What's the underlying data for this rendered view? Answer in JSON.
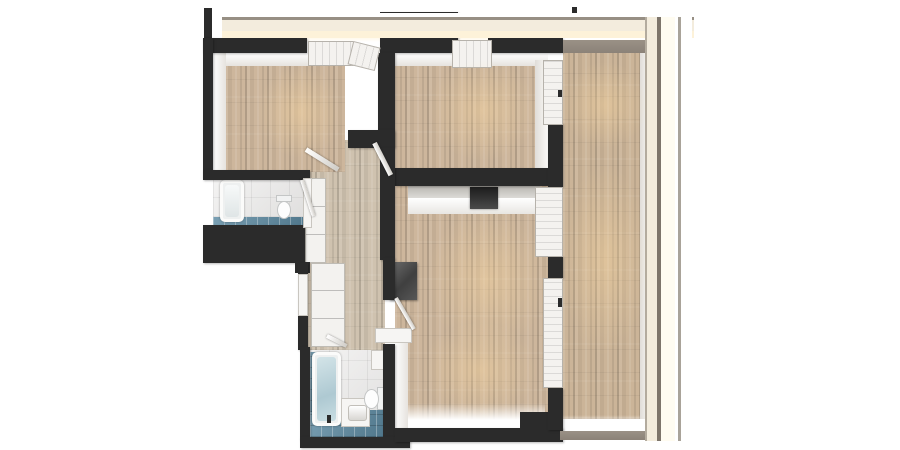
{
  "scene": {
    "title": "Apartment floor plan — top-down 3D render",
    "type": "architectural-floorplan-render",
    "view": "top-down",
    "background": "#ffffff",
    "text_visible": "none"
  },
  "palette": {
    "wall": "#2b2b2b",
    "wood": "#cdb69c",
    "hallWood": "#cfc2af",
    "balconyWood": "#cbb498",
    "whiteFace": "#f1efec",
    "tileFloor": "#e9e8e7",
    "blueTile": "#5d8ba3",
    "railCream": "#f3ecdd",
    "railBrown": "#8b8278",
    "counterTop": "#c9c7c3",
    "appliance": "#3b3b3b",
    "glow": "#ffdfae"
  },
  "rooms": [
    {
      "id": "bedroom-1",
      "label": "Bedroom 1 (top left)"
    },
    {
      "id": "bedroom-2",
      "label": "Bedroom 2 (top middle)"
    },
    {
      "id": "bathroom-1",
      "label": "Bathroom 1 (bathtub + toilet)"
    },
    {
      "id": "bathroom-2",
      "label": "Bathroom 2 (bathtub, vanity, toilet)"
    },
    {
      "id": "hallway",
      "label": "Hallway"
    },
    {
      "id": "living-kitchen",
      "label": "Living room / Kitchen"
    },
    {
      "id": "balcony",
      "label": "Balcony / Loggia"
    }
  ],
  "fixtures": [
    {
      "id": "bathtub-1",
      "label": "Bathtub"
    },
    {
      "id": "toilet-1",
      "label": "Toilet"
    },
    {
      "id": "bathtub-2",
      "label": "Bathtub with water"
    },
    {
      "id": "vanity",
      "label": "Vanity sink cabinet"
    },
    {
      "id": "toilet-2",
      "label": "Toilet"
    },
    {
      "id": "wall-cabinet",
      "label": "Wall cabinet"
    },
    {
      "id": "closet",
      "label": "Hall closet"
    },
    {
      "id": "wardrobe",
      "label": "Hallway wardrobe"
    },
    {
      "id": "kitchen-counter",
      "label": "Kitchen counter"
    },
    {
      "id": "cooktop",
      "label": "Cooktop"
    },
    {
      "id": "fridge",
      "label": "Tall kitchen unit / fridge"
    },
    {
      "id": "entry-door",
      "label": "Entry door"
    },
    {
      "id": "window-bed1",
      "label": "Bedroom 1 window"
    },
    {
      "id": "window-bed2",
      "label": "Bedroom 2 window"
    },
    {
      "id": "balcony-door",
      "label": "Balcony door"
    },
    {
      "id": "kitchen-window",
      "label": "Kitchen window"
    },
    {
      "id": "sliding-door",
      "label": "Sliding balcony door"
    },
    {
      "id": "railing",
      "label": "Glass balcony railing"
    },
    {
      "id": "interior-door",
      "label": "Interior door"
    }
  ]
}
